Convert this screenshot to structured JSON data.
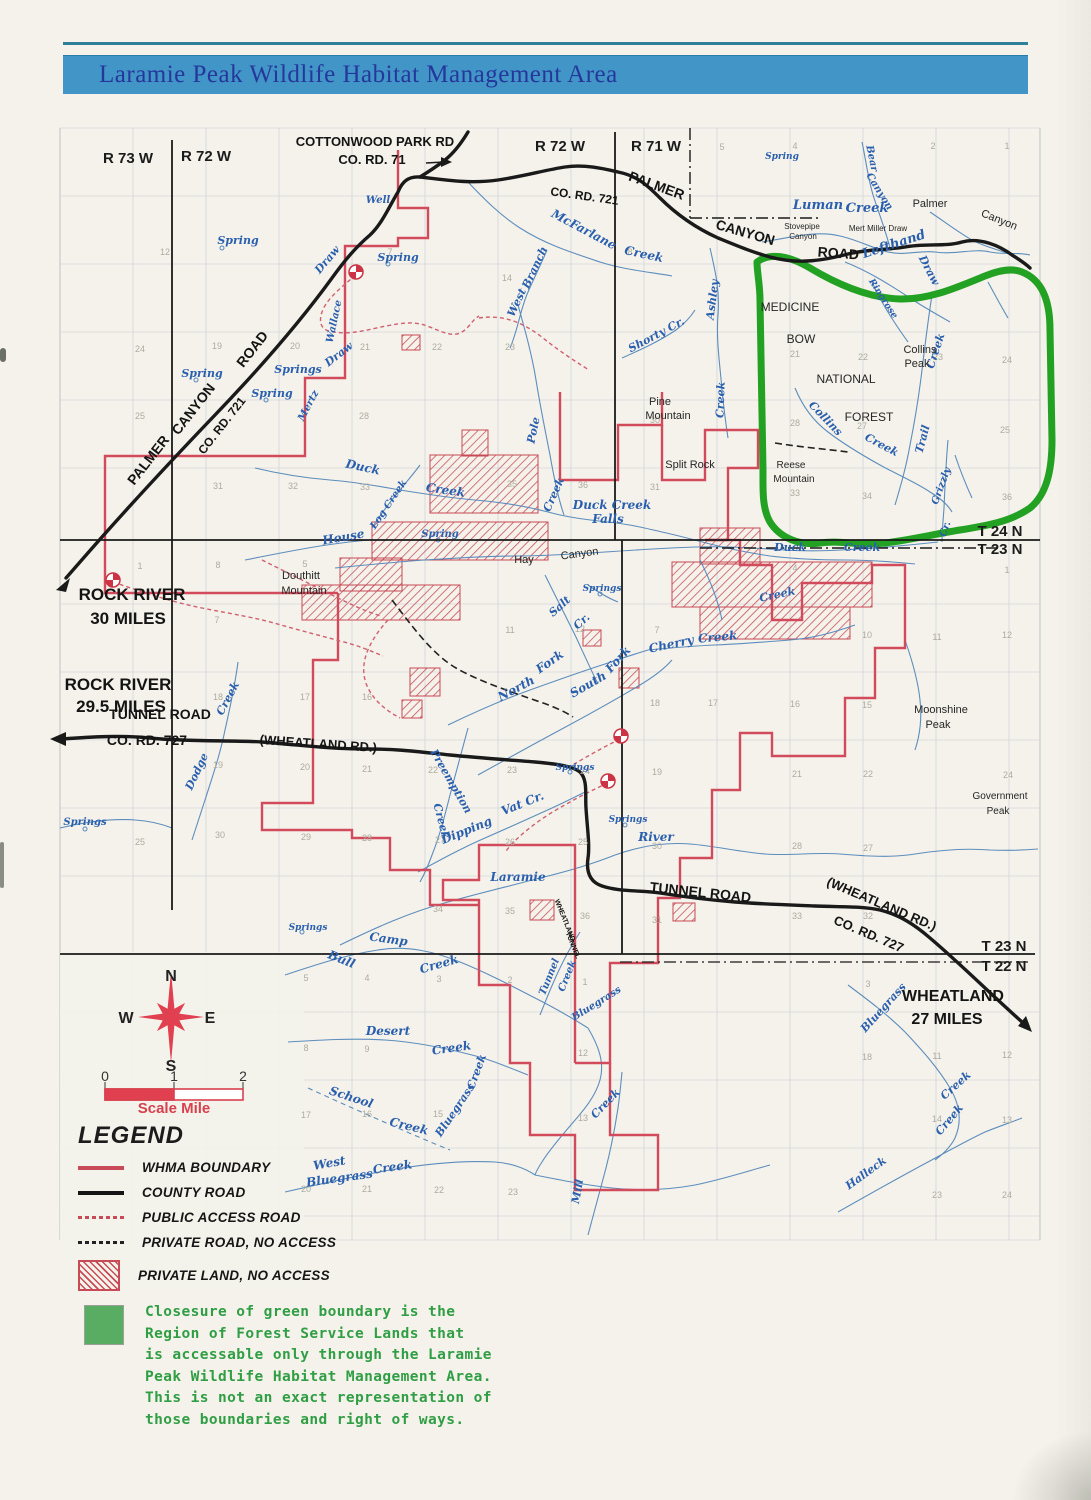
{
  "header": {
    "title": "Laramie Peak Wildlife Habitat Management Area"
  },
  "colors": {
    "banner_blue": "#4195c7",
    "title_text": "#26379b",
    "boundary_red": "#d14b5c",
    "county_road_black": "#1a1a1a",
    "creek_blue": "#5588bb",
    "forest_green": "#23a123",
    "note_green": "#2f9e44",
    "compass_red": "#e04050"
  },
  "legend": {
    "title": "LEGEND",
    "items": [
      {
        "swatch": "red-line",
        "label": "WHMA BOUNDARY"
      },
      {
        "swatch": "black-line",
        "label": "COUNTY ROAD"
      },
      {
        "swatch": "red-dash",
        "label": "PUBLIC ACCESS ROAD"
      },
      {
        "swatch": "black-dash",
        "label": "PRIVATE ROAD, NO ACCESS"
      },
      {
        "swatch": "red-hatch",
        "label": "PRIVATE LAND, NO ACCESS"
      }
    ]
  },
  "note": {
    "lines": [
      "Closesure of green boundary is the",
      "Region of Forest Service Lands that",
      "is accessable only through the Laramie",
      "Peak Wildlife Habitat Management Area.",
      "This is not an exact representation of",
      "those boundaries and right of ways."
    ]
  },
  "compass": {
    "letters": [
      [
        171,
        981,
        "N"
      ],
      [
        210,
        1023,
        "E"
      ],
      [
        171,
        1071,
        "S"
      ],
      [
        126,
        1023,
        "W"
      ]
    ]
  },
  "scale": {
    "ticks": [
      [
        105,
        1081,
        "0"
      ],
      [
        174,
        1081,
        "1"
      ],
      [
        243,
        1081,
        "2"
      ]
    ],
    "caption": [
      174,
      1113,
      "Scale Mile"
    ]
  },
  "map": {
    "range_labels": [
      [
        128,
        163,
        "R 73 W"
      ],
      [
        206,
        161,
        "R 72 W"
      ],
      [
        560,
        151,
        "R 72 W"
      ],
      [
        656,
        151,
        "R 71 W"
      ],
      [
        1000,
        536,
        "T 24 N"
      ],
      [
        1000,
        554,
        "T 23 N"
      ],
      [
        1004,
        951,
        "T 23 N"
      ],
      [
        1004,
        971,
        "T 22 N"
      ]
    ],
    "road_labels": [
      [
        375,
        146,
        "COTTONWOOD PARK RD",
        0,
        13
      ],
      [
        372,
        164,
        "CO. RD. 71",
        0,
        13
      ],
      [
        655,
        190,
        "PALMER",
        20,
        14
      ],
      [
        744,
        237,
        "CANYON",
        16,
        14
      ],
      [
        838,
        258,
        "ROAD",
        4,
        14
      ],
      [
        584,
        200,
        "CO. RD. 721",
        8,
        12
      ],
      [
        152,
        463,
        "PALMER",
        -52,
        14
      ],
      [
        197,
        412,
        "CANYON",
        -52,
        14
      ],
      [
        256,
        352,
        "ROAD",
        -52,
        14
      ],
      [
        225,
        428,
        "CO. RD. 721",
        -52,
        12
      ],
      [
        160,
        719,
        "TUNNEL ROAD",
        0,
        14
      ],
      [
        147,
        745,
        "CO. RD. 727",
        0,
        14
      ],
      [
        318,
        748,
        "(WHEATLAND RD.)",
        4,
        13
      ],
      [
        700,
        897,
        "TUNNEL ROAD",
        6,
        14
      ],
      [
        880,
        908,
        "(WHEATLAND RD.)",
        23,
        13
      ],
      [
        867,
        938,
        "CO. RD. 727",
        23,
        13
      ],
      [
        563,
        921,
        "WHEATLAND",
        68,
        7
      ],
      [
        571,
        946,
        "TUNNEL",
        68,
        7
      ],
      [
        132,
        600,
        "ROCK RIVER",
        0,
        17
      ],
      [
        128,
        624,
        "30 MILES",
        0,
        17
      ],
      [
        118,
        690,
        "ROCK RIVER",
        0,
        17
      ],
      [
        121,
        712,
        "29.5 MILES",
        0,
        17
      ],
      [
        953,
        1001,
        "WHEATLAND",
        0,
        16
      ],
      [
        947,
        1024,
        "27 MILES",
        0,
        16
      ]
    ],
    "place_labels": [
      [
        790,
        311,
        "MEDICINE",
        0,
        12
      ],
      [
        801,
        343,
        "BOW",
        0,
        12
      ],
      [
        846,
        383,
        "NATIONAL",
        0,
        12
      ],
      [
        869,
        421,
        "FOREST",
        0,
        12
      ],
      [
        920,
        353,
        "Collins",
        0,
        11
      ],
      [
        917,
        367,
        "Peak",
        0,
        11
      ],
      [
        660,
        405,
        "Pine",
        0,
        11
      ],
      [
        668,
        419,
        "Mountain",
        0,
        11
      ],
      [
        690,
        468,
        "Split Rock",
        0,
        11
      ],
      [
        791,
        468,
        "Reese",
        0,
        10
      ],
      [
        794,
        482,
        "Mountain",
        0,
        10
      ],
      [
        301,
        579,
        "Douthitt",
        0,
        11
      ],
      [
        304,
        594,
        "Mountain",
        0,
        11
      ],
      [
        941,
        713,
        "Moonshine",
        0,
        11
      ],
      [
        938,
        728,
        "Peak",
        0,
        11
      ],
      [
        1000,
        799,
        "Government",
        0,
        10
      ],
      [
        998,
        814,
        "Peak",
        0,
        10
      ],
      [
        878,
        231,
        "Mert Miller Draw",
        0,
        8
      ],
      [
        802,
        229,
        "Stovepipe",
        0,
        8
      ],
      [
        803,
        239,
        "Canyon",
        0,
        8
      ],
      [
        930,
        207,
        "Palmer",
        0,
        11
      ],
      [
        998,
        223,
        "Canyon",
        22,
        11
      ],
      [
        524,
        563,
        "Hay",
        0,
        11
      ],
      [
        580,
        557,
        "Canyon",
        -8,
        11
      ]
    ],
    "creek_labels": [
      [
        238,
        244,
        "Spring",
        0,
        11
      ],
      [
        378,
        203,
        "Well",
        0,
        10
      ],
      [
        398,
        261,
        "Spring",
        0,
        11
      ],
      [
        330,
        262,
        "Draw",
        -50,
        11
      ],
      [
        337,
        322,
        "Wallace",
        -78,
        10
      ],
      [
        341,
        357,
        "Draw",
        -38,
        11
      ],
      [
        202,
        377,
        "Spring",
        0,
        11
      ],
      [
        298,
        373,
        "Springs",
        0,
        11
      ],
      [
        272,
        397,
        "Spring",
        0,
        11
      ],
      [
        311,
        407,
        "Mertz",
        -62,
        10
      ],
      [
        582,
        233,
        "McFarlane",
        28,
        12
      ],
      [
        643,
        258,
        "Creek",
        12,
        12
      ],
      [
        520,
        304,
        "West",
        -65,
        11
      ],
      [
        538,
        269,
        "Branch",
        -65,
        11
      ],
      [
        658,
        338,
        "Shorty Cr.",
        -28,
        11
      ],
      [
        716,
        300,
        "Ashley",
        -83,
        11
      ],
      [
        724,
        400,
        "Creek",
        -88,
        11
      ],
      [
        818,
        209,
        "Luman",
        0,
        13
      ],
      [
        867,
        212,
        "Creek",
        0,
        13
      ],
      [
        869,
        159,
        "Bear",
        78,
        10
      ],
      [
        877,
        193,
        "Canyon",
        58,
        10
      ],
      [
        895,
        248,
        "Lefthand",
        -18,
        13
      ],
      [
        926,
        272,
        "Draw",
        62,
        11
      ],
      [
        881,
        300,
        "Ringrose",
        57,
        9
      ],
      [
        782,
        159,
        "Spring",
        0,
        9
      ],
      [
        823,
        421,
        "Collins",
        46,
        11
      ],
      [
        880,
        448,
        "Creek",
        28,
        11
      ],
      [
        926,
        440,
        "Trail",
        -75,
        11
      ],
      [
        939,
        352,
        "Creek",
        -72,
        11
      ],
      [
        944,
        487,
        "Grizzly",
        -70,
        10
      ],
      [
        948,
        530,
        "Cr.",
        -70,
        10
      ],
      [
        537,
        431,
        "Pole",
        -78,
        11
      ],
      [
        557,
        496,
        "Creek",
        -66,
        11
      ],
      [
        612,
        509,
        "Duck Creek",
        0,
        12
      ],
      [
        608,
        523,
        "Falls",
        0,
        12
      ],
      [
        362,
        471,
        "Duck",
        12,
        12
      ],
      [
        445,
        494,
        "Creek",
        8,
        12
      ],
      [
        391,
        506,
        "Log Creek",
        -56,
        10
      ],
      [
        344,
        541,
        "House",
        -10,
        12
      ],
      [
        440,
        537,
        "Spring",
        0,
        10
      ],
      [
        790,
        551,
        "Duck",
        0,
        11
      ],
      [
        862,
        551,
        "Creek",
        0,
        11
      ],
      [
        778,
        598,
        "Creek",
        -12,
        11
      ],
      [
        562,
        609,
        "Salt",
        -42,
        11
      ],
      [
        584,
        624,
        "Cr.",
        -42,
        11
      ],
      [
        602,
        591,
        "Springs",
        0,
        9
      ],
      [
        518,
        692,
        "North",
        -28,
        12
      ],
      [
        552,
        665,
        "Fork",
        -35,
        12
      ],
      [
        590,
        688,
        "South",
        -30,
        12
      ],
      [
        621,
        662,
        "Fork",
        -48,
        12
      ],
      [
        672,
        648,
        "Cherry",
        -12,
        12
      ],
      [
        718,
        641,
        "Creek",
        -5,
        12
      ],
      [
        448,
        783,
        "Preemption",
        60,
        11
      ],
      [
        438,
        822,
        "Creek",
        75,
        11
      ],
      [
        468,
        834,
        "Dipping",
        -22,
        12
      ],
      [
        524,
        807,
        "Vat Cr.",
        -22,
        12
      ],
      [
        200,
        773,
        "Dodge",
        -65,
        11
      ],
      [
        231,
        700,
        "Creek",
        -62,
        11
      ],
      [
        85,
        825,
        "Springs",
        0,
        10
      ],
      [
        308,
        930,
        "Springs",
        0,
        9
      ],
      [
        575,
        770,
        "Springs",
        0,
        9
      ],
      [
        628,
        822,
        "Springs",
        0,
        9
      ],
      [
        518,
        881,
        "Laramie",
        0,
        12
      ],
      [
        656,
        841,
        "River",
        0,
        12
      ],
      [
        340,
        963,
        "Bull",
        22,
        12
      ],
      [
        388,
        943,
        "Camp",
        8,
        12
      ],
      [
        440,
        968,
        "Creek",
        -16,
        12
      ],
      [
        388,
        1035,
        "Desert",
        0,
        12
      ],
      [
        452,
        1052,
        "Creek",
        -8,
        12
      ],
      [
        350,
        1101,
        "School",
        18,
        12
      ],
      [
        408,
        1130,
        "Creek",
        14,
        12
      ],
      [
        458,
        1112,
        "Bluegrass",
        -56,
        11
      ],
      [
        480,
        1073,
        "Creek",
        -70,
        11
      ],
      [
        330,
        1167,
        "West",
        -10,
        12
      ],
      [
        340,
        1182,
        "Bluegrass",
        -8,
        12
      ],
      [
        393,
        1171,
        "Creek",
        -8,
        12
      ],
      [
        552,
        978,
        "Tunnel",
        -68,
        10
      ],
      [
        570,
        977,
        "Creek",
        -68,
        10
      ],
      [
        598,
        1006,
        "Bluegrass",
        -32,
        10
      ],
      [
        886,
        1010,
        "Bluegrass",
        -48,
        11
      ],
      [
        958,
        1088,
        "Creek",
        -42,
        11
      ],
      [
        952,
        1122,
        "Creek",
        -50,
        11
      ],
      [
        868,
        1176,
        "Halleck",
        -36,
        11
      ],
      [
        581,
        1192,
        "Mill",
        -80,
        11
      ],
      [
        608,
        1106,
        "Creek",
        -46,
        11
      ]
    ],
    "section_numbers": [
      [
        165,
        255,
        "12"
      ],
      [
        390,
        255,
        "7"
      ],
      [
        630,
        255,
        "8"
      ],
      [
        722,
        150,
        "5"
      ],
      [
        795,
        149,
        "4"
      ],
      [
        933,
        149,
        "2"
      ],
      [
        1007,
        149,
        "1"
      ],
      [
        140,
        352,
        "24"
      ],
      [
        217,
        349,
        "19"
      ],
      [
        295,
        349,
        "20"
      ],
      [
        365,
        350,
        "21"
      ],
      [
        437,
        350,
        "22"
      ],
      [
        510,
        350,
        "23"
      ],
      [
        507,
        281,
        "14"
      ],
      [
        140,
        419,
        "25"
      ],
      [
        364,
        419,
        "28"
      ],
      [
        795,
        357,
        "21"
      ],
      [
        863,
        360,
        "22"
      ],
      [
        938,
        360,
        "23"
      ],
      [
        1007,
        363,
        "24"
      ],
      [
        795,
        426,
        "28"
      ],
      [
        862,
        429,
        "27"
      ],
      [
        1005,
        433,
        "25"
      ],
      [
        795,
        496,
        "33"
      ],
      [
        867,
        499,
        "34"
      ],
      [
        1007,
        500,
        "36"
      ],
      [
        218,
        489,
        "31"
      ],
      [
        293,
        489,
        "32"
      ],
      [
        365,
        490,
        "33"
      ],
      [
        512,
        487,
        "35"
      ],
      [
        583,
        488,
        "36"
      ],
      [
        655,
        490,
        "31"
      ],
      [
        655,
        423,
        "30"
      ],
      [
        140,
        569,
        "1"
      ],
      [
        218,
        568,
        "8"
      ],
      [
        305,
        567,
        "5"
      ],
      [
        217,
        623,
        "7"
      ],
      [
        795,
        571,
        "4"
      ],
      [
        1007,
        573,
        "1"
      ],
      [
        867,
        638,
        "10"
      ],
      [
        937,
        640,
        "11"
      ],
      [
        1007,
        638,
        "12"
      ],
      [
        218,
        700,
        "18"
      ],
      [
        305,
        700,
        "17"
      ],
      [
        367,
        700,
        "16"
      ],
      [
        510,
        633,
        "11"
      ],
      [
        580,
        632,
        "12"
      ],
      [
        657,
        633,
        "7"
      ],
      [
        655,
        706,
        "18"
      ],
      [
        713,
        706,
        "17"
      ],
      [
        795,
        707,
        "16"
      ],
      [
        867,
        708,
        "15"
      ],
      [
        218,
        768,
        "19"
      ],
      [
        305,
        770,
        "20"
      ],
      [
        367,
        772,
        "21"
      ],
      [
        433,
        773,
        "22"
      ],
      [
        512,
        773,
        "23"
      ],
      [
        585,
        774,
        "24"
      ],
      [
        657,
        775,
        "19"
      ],
      [
        797,
        777,
        "21"
      ],
      [
        868,
        777,
        "22"
      ],
      [
        1008,
        778,
        "24"
      ],
      [
        140,
        845,
        "25"
      ],
      [
        220,
        838,
        "30"
      ],
      [
        306,
        840,
        "29"
      ],
      [
        367,
        841,
        "28"
      ],
      [
        440,
        843,
        "27"
      ],
      [
        510,
        845,
        "26"
      ],
      [
        583,
        845,
        "25"
      ],
      [
        657,
        849,
        "30"
      ],
      [
        797,
        849,
        "28"
      ],
      [
        868,
        851,
        "27"
      ],
      [
        438,
        912,
        "34"
      ],
      [
        510,
        914,
        "35"
      ],
      [
        585,
        919,
        "36"
      ],
      [
        657,
        923,
        "31"
      ],
      [
        797,
        919,
        "33"
      ],
      [
        868,
        919,
        "32"
      ],
      [
        306,
        981,
        "5"
      ],
      [
        367,
        981,
        "4"
      ],
      [
        439,
        982,
        "3"
      ],
      [
        510,
        983,
        "2"
      ],
      [
        585,
        985,
        "1"
      ],
      [
        868,
        987,
        "3"
      ],
      [
        306,
        1051,
        "8"
      ],
      [
        367,
        1052,
        "9"
      ],
      [
        583,
        1056,
        "12"
      ],
      [
        867,
        1060,
        "18"
      ],
      [
        937,
        1059,
        "11"
      ],
      [
        1007,
        1058,
        "12"
      ],
      [
        306,
        1118,
        "17"
      ],
      [
        367,
        1117,
        "16"
      ],
      [
        438,
        1117,
        "15"
      ],
      [
        583,
        1121,
        "13"
      ],
      [
        937,
        1122,
        "14"
      ],
      [
        1007,
        1123,
        "13"
      ],
      [
        306,
        1192,
        "20"
      ],
      [
        367,
        1192,
        "21"
      ],
      [
        439,
        1193,
        "22"
      ],
      [
        513,
        1195,
        "23"
      ],
      [
        937,
        1198,
        "23"
      ],
      [
        1007,
        1198,
        "24"
      ]
    ],
    "access_points": [
      [
        113,
        580
      ],
      [
        356,
        272
      ],
      [
        621,
        736
      ],
      [
        608,
        781
      ]
    ],
    "spring_dots": [
      [
        222,
        248
      ],
      [
        388,
        264
      ],
      [
        196,
        380
      ],
      [
        266,
        400
      ],
      [
        600,
        594
      ],
      [
        570,
        772
      ],
      [
        302,
        932
      ],
      [
        438,
        540
      ],
      [
        85,
        829
      ],
      [
        625,
        825
      ]
    ]
  }
}
